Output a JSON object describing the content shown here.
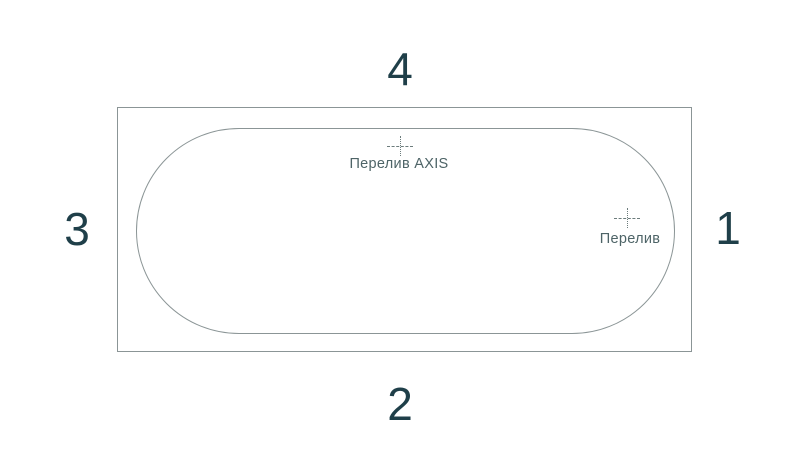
{
  "diagram": {
    "type": "bathtub-top-view",
    "sides": [
      {
        "label": "1",
        "position": "right"
      },
      {
        "label": "2",
        "position": "bottom"
      },
      {
        "label": "3",
        "position": "left"
      },
      {
        "label": "4",
        "position": "top"
      }
    ],
    "markers": [
      {
        "label": "Перелив AXIS",
        "position": "top-center-of-basin"
      },
      {
        "label": "Перелив",
        "position": "right-of-basin"
      }
    ],
    "colors": {
      "background": "#ffffff",
      "number": "#1f3f49",
      "outline": "#8b9596",
      "basin_outline": "#8b9596",
      "label_text": "#4e6467",
      "marker": "#6c7c7c"
    }
  }
}
